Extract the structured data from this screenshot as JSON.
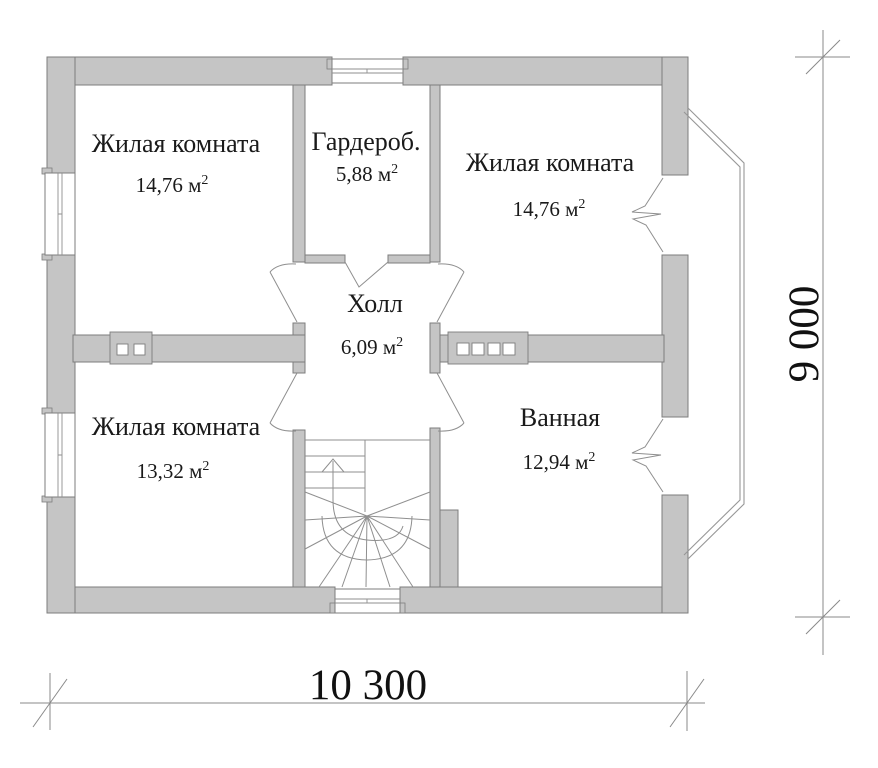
{
  "plan": {
    "type": "floor-plan",
    "language": "ru",
    "rooms": [
      {
        "id": "living-top-left",
        "name": "Жилая комната",
        "area": "14,76 м²",
        "area_value": "14,76 м",
        "area_sup": "2"
      },
      {
        "id": "wardrobe",
        "name": "Гардероб.",
        "area": "5,88 м²",
        "area_value": "5,88 м",
        "area_sup": "2"
      },
      {
        "id": "living-top-right",
        "name": "Жилая комната",
        "area": "14,76 м²",
        "area_value": "14,76 м",
        "area_sup": "2"
      },
      {
        "id": "hall",
        "name": "Холл",
        "area": "6,09 м²",
        "area_value": "6,09 м",
        "area_sup": "2"
      },
      {
        "id": "living-bottom-left",
        "name": "Жилая комната",
        "area": "13,32 м²",
        "area_value": "13,32 м",
        "area_sup": "2"
      },
      {
        "id": "bathroom",
        "name": "Ванная",
        "area": "12,94 м²",
        "area_value": "12,94 м",
        "area_sup": "2"
      }
    ],
    "dimensions": {
      "width_label": "10 300",
      "height_label": "9 000"
    },
    "colors": {
      "wall_fill": "#c5c5c5",
      "wall_outline": "#7d7d7d",
      "line": "#8f8f8f",
      "text": "#1a1a1a",
      "background": "#ffffff"
    }
  }
}
